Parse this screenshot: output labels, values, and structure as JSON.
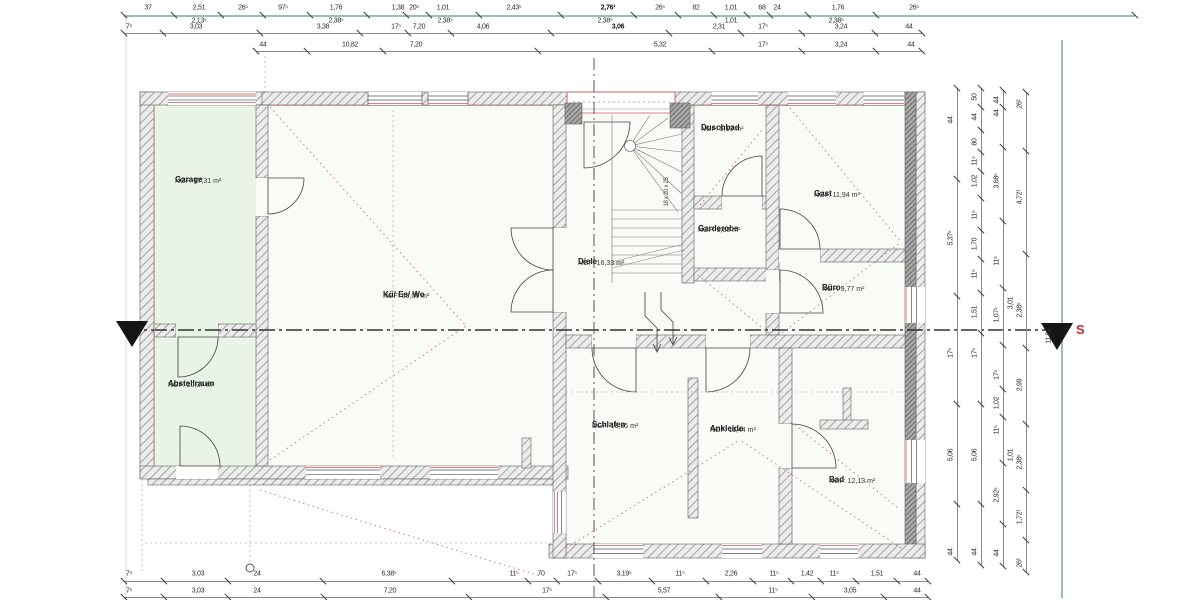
{
  "section_label": "S",
  "colors": {
    "teal": "#9dbfae",
    "dim": "#8a8a8a",
    "accent_red": "#cc5555",
    "room_green": "#e9f3e6"
  },
  "rooms": [
    {
      "id": "garage",
      "name": "Garage",
      "area": "NGF: 17,31 m²",
      "x": 175,
      "y": 176
    },
    {
      "id": "kue-es-wo",
      "name": "Kü/ Es/ Wo",
      "area": "NGF: 65,08 m²",
      "x": 383,
      "y": 291
    },
    {
      "id": "abstellraum",
      "name": "Abstellraum",
      "area": "NGF: 10,37 m²",
      "x": 168,
      "y": 380
    },
    {
      "id": "diele",
      "name": "Diele",
      "area": "NGF: 16,33 m²",
      "x": 578,
      "y": 258
    },
    {
      "id": "duschbad",
      "name": "Duschbad",
      "area": "NGF: 5,13 m²",
      "x": 701,
      "y": 124
    },
    {
      "id": "garderobe",
      "name": "Garderobe",
      "area": "NGF: 3,80 m²",
      "x": 698,
      "y": 225
    },
    {
      "id": "gast",
      "name": "Gast",
      "area": "NGF: 11,94 m²",
      "x": 814,
      "y": 190
    },
    {
      "id": "buero",
      "name": "Büro",
      "area": "NGF: 9,77 m²",
      "x": 822,
      "y": 284
    },
    {
      "id": "schlafen",
      "name": "Schlafen",
      "area": "NGF: 16,35 m²",
      "x": 592,
      "y": 421
    },
    {
      "id": "ankleide",
      "name": "Ankleide",
      "area": "NGF: 11,44 m²",
      "x": 710,
      "y": 425
    },
    {
      "id": "bad",
      "name": "Bad",
      "area": "NGF: 12,13 m²",
      "x": 829,
      "y": 476
    }
  ],
  "extra_labels": [
    {
      "id": "stairs-dim",
      "t": "18 x 20 x 25",
      "x": 667,
      "y": 192,
      "rot": true
    }
  ],
  "dim_chains_h": [
    {
      "id": "top-1",
      "teal": true,
      "y": 15,
      "label_y": 8,
      "line": [
        124,
        1135
      ],
      "labels": [
        {
          "t": "37",
          "x": 148
        },
        {
          "t": "2,51",
          "x": 199
        },
        {
          "t": "26⁵",
          "x": 243
        },
        {
          "t": "97⁵",
          "x": 283
        },
        {
          "t": "1,76",
          "x": 336
        },
        {
          "t": "1,38",
          "x": 398
        },
        {
          "t": "20⁵",
          "x": 414
        },
        {
          "t": "1,01",
          "x": 443
        },
        {
          "t": "2,43⁵",
          "x": 514
        },
        {
          "t": "2,76¹",
          "x": 608,
          "b": true
        },
        {
          "t": "26⁵",
          "x": 660
        },
        {
          "t": "82",
          "x": 696
        },
        {
          "t": "1,01",
          "x": 731
        },
        {
          "t": "68",
          "x": 762
        },
        {
          "t": "24",
          "x": 777
        },
        {
          "t": "1,76",
          "x": 838
        },
        {
          "t": "26⁵",
          "x": 914
        }
      ]
    },
    {
      "id": "top-1b",
      "y": 15,
      "label_y": 21,
      "line": null,
      "labels": [
        {
          "t": "2,13⁵",
          "x": 199
        },
        {
          "t": "2,38⁵",
          "x": 336
        },
        {
          "t": "2,38⁵",
          "x": 445
        },
        {
          "t": "2,38⁵",
          "x": 605
        },
        {
          "t": "1,01",
          "x": 731
        },
        {
          "t": "2,38⁵",
          "x": 836
        }
      ]
    },
    {
      "id": "top-2",
      "y": 33,
      "label_y": 27,
      "line": [
        124,
        922
      ],
      "labels": [
        {
          "t": "7⁵",
          "x": 129
        },
        {
          "t": "3,03",
          "x": 196
        },
        {
          "t": "3,38",
          "x": 323
        },
        {
          "t": "17⁵",
          "x": 396
        },
        {
          "t": "7,20",
          "x": 419
        },
        {
          "t": "4,06",
          "x": 483
        },
        {
          "t": "3,06",
          "x": 618,
          "b": true
        },
        {
          "t": "2,31",
          "x": 719
        },
        {
          "t": "17⁵",
          "x": 763
        },
        {
          "t": "3,24",
          "x": 841
        },
        {
          "t": "44",
          "x": 909
        }
      ]
    },
    {
      "id": "top-3",
      "y": 51,
      "label_y": 45,
      "line": [
        256,
        922
      ],
      "labels": [
        {
          "t": "44",
          "x": 263
        },
        {
          "t": "10,82",
          "x": 350
        },
        {
          "t": "7,20",
          "x": 416
        },
        {
          "t": "5,32",
          "x": 660
        },
        {
          "t": "17⁵",
          "x": 763
        },
        {
          "t": "3,24",
          "x": 841
        },
        {
          "t": "44",
          "x": 911
        }
      ]
    },
    {
      "id": "bottom-1",
      "y": 581,
      "label_y": 574,
      "line": [
        124,
        928
      ],
      "labels": [
        {
          "t": "7⁵",
          "x": 129
        },
        {
          "t": "3,03",
          "x": 198
        },
        {
          "t": "24",
          "x": 257
        },
        {
          "t": "6,38⁵",
          "x": 389
        },
        {
          "t": "11⁵",
          "x": 514
        },
        {
          "t": "70",
          "x": 541
        },
        {
          "t": "17⁵",
          "x": 572
        },
        {
          "t": "3,19⁵",
          "x": 624
        },
        {
          "t": "11⁵",
          "x": 680
        },
        {
          "t": "2,26",
          "x": 731
        },
        {
          "t": "11⁵",
          "x": 774
        },
        {
          "t": "1,42",
          "x": 807
        },
        {
          "t": "11⁵",
          "x": 834
        },
        {
          "t": "1,51",
          "x": 877
        },
        {
          "t": "44",
          "x": 917
        }
      ]
    },
    {
      "id": "bottom-2",
      "y": 597,
      "label_y": 591,
      "line": [
        124,
        928
      ],
      "labels": [
        {
          "t": "7⁵",
          "x": 129
        },
        {
          "t": "3,03",
          "x": 198
        },
        {
          "t": "24",
          "x": 257
        },
        {
          "t": "7,20",
          "x": 390
        },
        {
          "t": "17⁵",
          "x": 547
        },
        {
          "t": "5,57",
          "x": 664
        },
        {
          "t": "11⁵",
          "x": 773
        },
        {
          "t": "3,05",
          "x": 850
        },
        {
          "t": "44",
          "x": 917
        }
      ]
    }
  ],
  "dim_chains_v": [
    {
      "id": "right-1",
      "x": 957,
      "label_x": 951,
      "line": [
        88,
        560
      ],
      "labels": [
        {
          "t": "44",
          "y": 120
        },
        {
          "t": "5,37⁵",
          "y": 238
        },
        {
          "t": "17⁵",
          "y": 353
        },
        {
          "t": "5,06",
          "y": 455
        },
        {
          "t": "44",
          "y": 552
        }
      ]
    },
    {
      "id": "right-2",
      "x": 981,
      "label_x": 975,
      "line": [
        88,
        565
      ],
      "labels": [
        {
          "t": "50",
          "y": 97
        },
        {
          "t": "44",
          "y": 117
        },
        {
          "t": "80",
          "y": 142
        },
        {
          "t": "11⁵",
          "y": 161
        },
        {
          "t": "1,02",
          "y": 181
        },
        {
          "t": "11⁵",
          "y": 215
        },
        {
          "t": "1,70",
          "y": 244
        },
        {
          "t": "11⁵",
          "y": 274
        },
        {
          "t": "1,51",
          "y": 312
        },
        {
          "t": "17⁵",
          "y": 353
        },
        {
          "t": "5,06",
          "y": 455
        },
        {
          "t": "44",
          "y": 552
        }
      ]
    },
    {
      "id": "right-3",
      "x": 1003,
      "label_x": 997,
      "line": [
        90,
        566
      ],
      "labels": [
        {
          "t": "44",
          "y": 100
        },
        {
          "t": "44",
          "y": 113
        },
        {
          "t": "3,68⁵",
          "y": 181
        },
        {
          "t": "11⁵",
          "y": 261
        },
        {
          "t": "1,07⁵",
          "y": 315
        },
        {
          "t": "17⁵",
          "y": 375
        },
        {
          "t": "1,02",
          "y": 403
        },
        {
          "t": "11⁵",
          "y": 430
        },
        {
          "t": "2,92⁵",
          "y": 495
        },
        {
          "t": "44",
          "y": 553
        }
      ]
    },
    {
      "id": "right-4",
      "x": 1026,
      "label_x": 1020,
      "line": [
        92,
        572
      ],
      "labels": [
        {
          "t": "26¹",
          "y": 104
        },
        {
          "t": "4,72¹",
          "y": 197
        },
        {
          "t": "2,38⁵",
          "y": 310
        },
        {
          "t": "2,99",
          "y": 385
        },
        {
          "t": "2,38⁵",
          "y": 462
        },
        {
          "t": "1,72¹",
          "y": 517
        },
        {
          "t": "26¹",
          "y": 563
        }
      ]
    },
    {
      "id": "right-4a",
      "x": 1014,
      "label_x": 1011,
      "line": null,
      "labels": [
        {
          "t": "3,01",
          "y": 303
        },
        {
          "t": "1,01",
          "y": 455
        }
      ]
    },
    {
      "id": "right-total",
      "x": 1053,
      "label_x": 1049,
      "line": null,
      "labels": [
        {
          "t": "11,99",
          "y": 336
        }
      ]
    }
  ]
}
